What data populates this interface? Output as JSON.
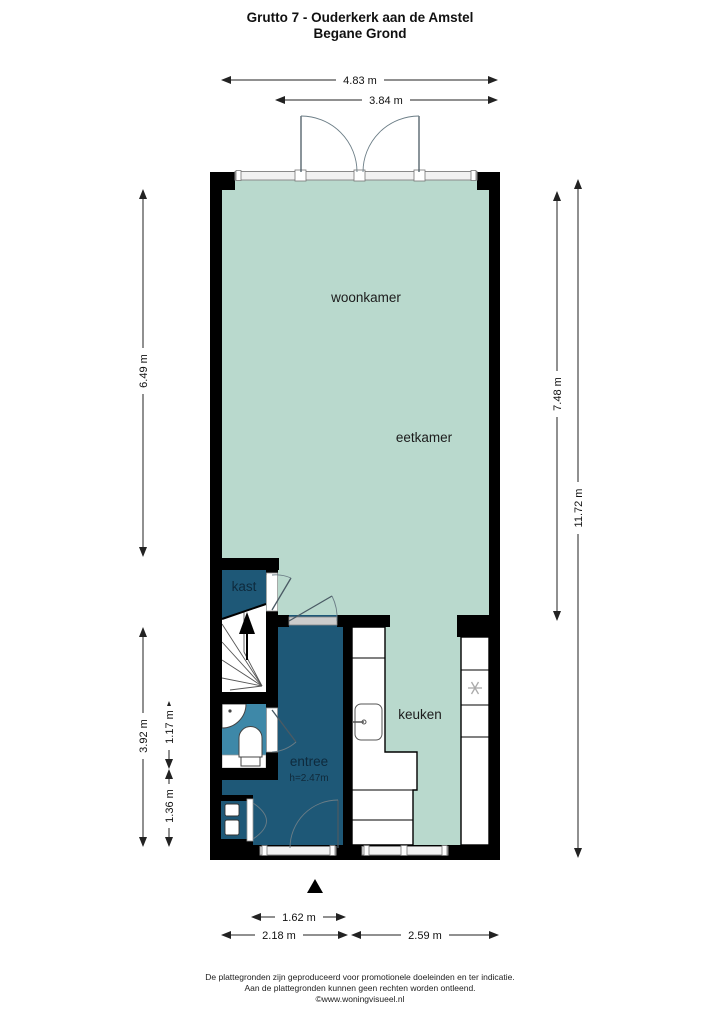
{
  "header": {
    "title_line1": "Grutto 7 - Ouderkerk aan de Amstel",
    "title_line2": "Begane Grond"
  },
  "rooms": {
    "woonkamer": "woonkamer",
    "eetkamer": "eetkamer",
    "kast": "kast",
    "entree": "entree",
    "entree_height": "h=2.47m",
    "keuken": "keuken"
  },
  "dimensions": {
    "top_width": "4.83 m",
    "top_inner_width": "3.84 m",
    "left_height": "6.49 m",
    "right_inner_height": "7.48 m",
    "right_total_height": "11.72 m",
    "lower_left_height": "3.92 m",
    "toilet_height": "1.17 m",
    "hall_height": "1.36 m",
    "door_width": "1.62 m",
    "bottom_left_width": "2.18 m",
    "bottom_right_width": "2.59 m"
  },
  "footer": {
    "line1": "De plattegronden zijn geproduceerd voor promotionele doeleinden en ter indicatie.",
    "line2": "Aan de plattegronden kunnen geen rechten worden ontleend.",
    "line3": "©www.woningvisueel.nl"
  },
  "colors": {
    "floor": "#b9d9cd",
    "hall": "#1e5877",
    "toilet": "#3e88a8",
    "wall": "#000000"
  }
}
